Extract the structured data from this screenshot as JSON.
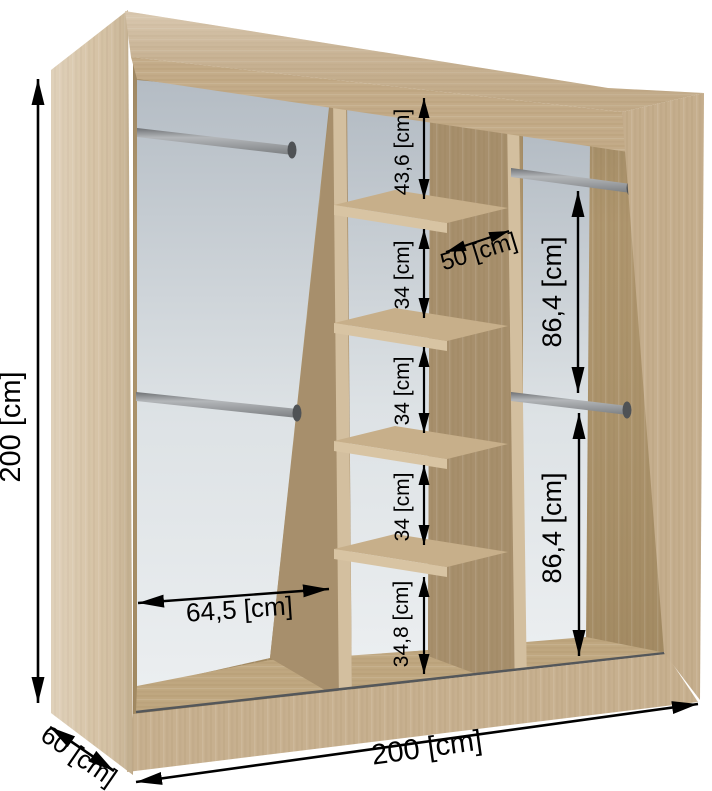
{
  "diagram": {
    "type": "wardrobe-dimension-diagram",
    "subject": "sliding-door wardrobe interior with shelves and hanging rails",
    "unit": "cm"
  },
  "dimensions": {
    "height": "200 [cm]",
    "width": "200 [cm]",
    "depth": "60 [cm]",
    "left_section_width": "64,5 [cm]",
    "middle_section_width": "50 [cm]",
    "middle_top_gap": "43,6 [cm]",
    "middle_gap_1": "34 [cm]",
    "middle_gap_2": "34 [cm]",
    "middle_gap_3": "34 [cm]",
    "middle_bottom_gap": "34,8 [cm]",
    "right_upper_gap": "86,4 [cm]",
    "right_lower_gap": "86,4 [cm]"
  },
  "colors": {
    "wood_side": "#d4c0a1",
    "wood_top": "#ccb492",
    "wood_top_edge": "#c3ab88",
    "wood_side_right": "#c5ae8d",
    "wood_inner": "#b0976f",
    "wood_partition": "#a78f6c",
    "wood_edge_light": "#d3bf9f",
    "wood_shelf_front": "#d8c4a3",
    "wood_shelf_top": "#c7af8a",
    "wood_floor": "#bfa780",
    "wood_base": "#c7b08f",
    "panel_gray_top": "#b4bcc4",
    "panel_gray_bottom": "#ebeef0",
    "metal_rod": "#909396",
    "metal_cap": "#4f5255",
    "track": "#54575a",
    "dimension": "#000000"
  }
}
